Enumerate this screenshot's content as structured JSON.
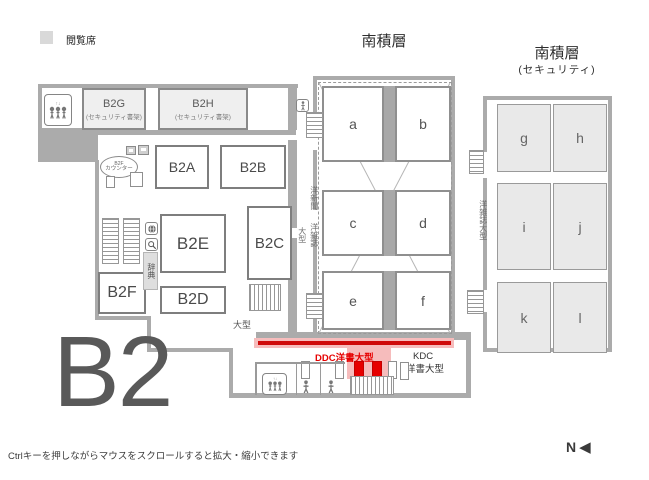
{
  "legend": {
    "label": "閲覧席",
    "swatch_color": "#d9d9d9"
  },
  "floor": {
    "label": "B2"
  },
  "footer": {
    "hint": "Ctrlキーを押しながらマウスをスクロールすると拡大・縮小できます"
  },
  "compass": {
    "n": "N",
    "arrow": "◀"
  },
  "rooms": {
    "b2g": {
      "name": "B2G",
      "subtitle": "(セキュリティ書架)"
    },
    "b2h": {
      "name": "B2H",
      "subtitle": "(セキュリティ書架)"
    },
    "b2a": {
      "name": "B2A"
    },
    "b2b": {
      "name": "B2B"
    },
    "b2c": {
      "name": "B2C"
    },
    "b2d": {
      "name": "B2D"
    },
    "b2e": {
      "name": "B2E"
    },
    "b2f": {
      "name": "B2F"
    }
  },
  "counter": {
    "line1": "B2F",
    "line2": "カウンター"
  },
  "center_stack": {
    "title": "南積層",
    "cells": [
      "a",
      "b",
      "c",
      "d",
      "e",
      "f"
    ],
    "label_newspapers": "洋新聞",
    "label_large": "大型",
    "label_magazines": "洋雑誌"
  },
  "right_stack": {
    "title": "南積層",
    "subtitle": "(セキュリティ)",
    "cells": [
      "g",
      "h",
      "i",
      "j",
      "k",
      "l"
    ],
    "label_west": "洋雑誌大型"
  },
  "shelves": {
    "ddc_label": "DDC洋書大型",
    "kdc_label_line1": "KDC",
    "kdc_label_line2": "洋書大型",
    "large_label": "大型",
    "dictionary_label": "辞典"
  },
  "colors": {
    "highlight_red": "#e60000",
    "highlight_pink": "#f6bcbc",
    "wall": "#ababab",
    "room_fill": "#efefef",
    "stack_cell_fill": "#e9e9e9",
    "floor_label_gray": "#595959"
  }
}
